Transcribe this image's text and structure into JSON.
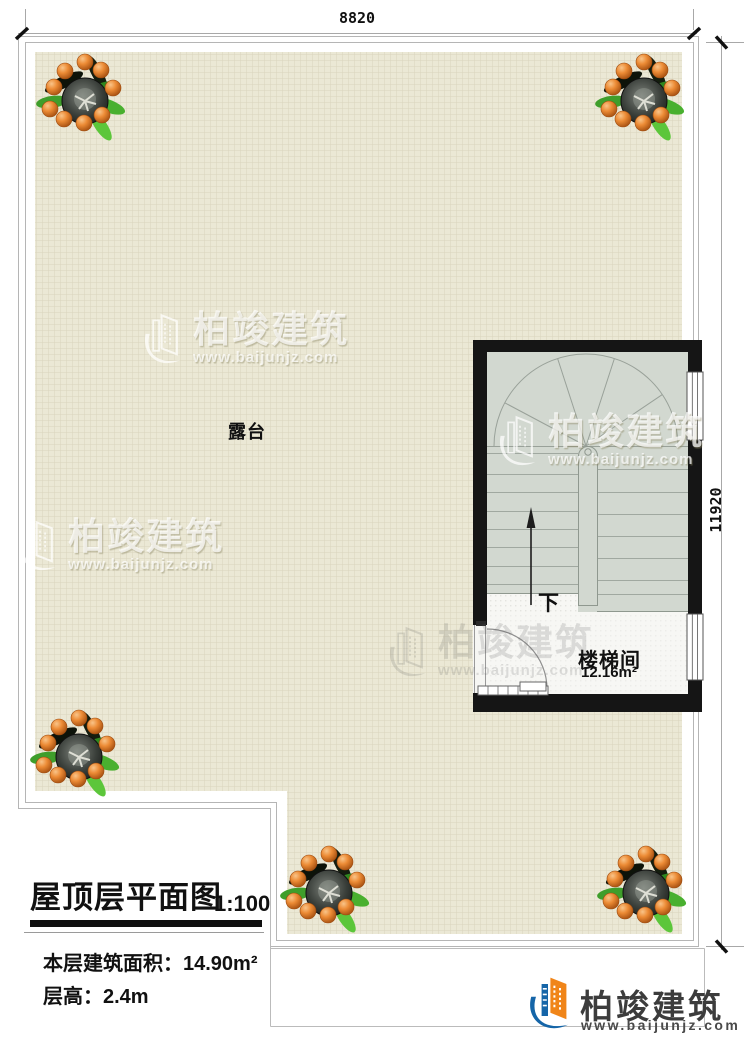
{
  "colors": {
    "wall": "#151515",
    "grid_bg": "#ebe8d5",
    "grid_line": "#d9d4bd",
    "stair_floor": "#d2d8d0",
    "landing_floor": "#f7f7f4",
    "brand_blue": "#1565a8",
    "brand_orange": "#f08519",
    "frame_line": "#b5b5b5"
  },
  "dimensions": {
    "width_label": "8820",
    "height_label": "11920"
  },
  "plan": {
    "terrace_label": "露台",
    "stair_room_label": "楼梯间",
    "stair_room_area": "12.16m²",
    "stair_direction_label": "下"
  },
  "watermark": {
    "brand": "柏竣建筑",
    "url": "www.baijunjz.com"
  },
  "title_block": {
    "title": "屋顶层平面图",
    "scale": "1:100",
    "floor_area_line": "本层建筑面积：14.90m²",
    "floor_height_line": "层高：2.4m"
  },
  "logo": {
    "brand": "柏竣建筑",
    "url": "www.baijunjz.com"
  }
}
